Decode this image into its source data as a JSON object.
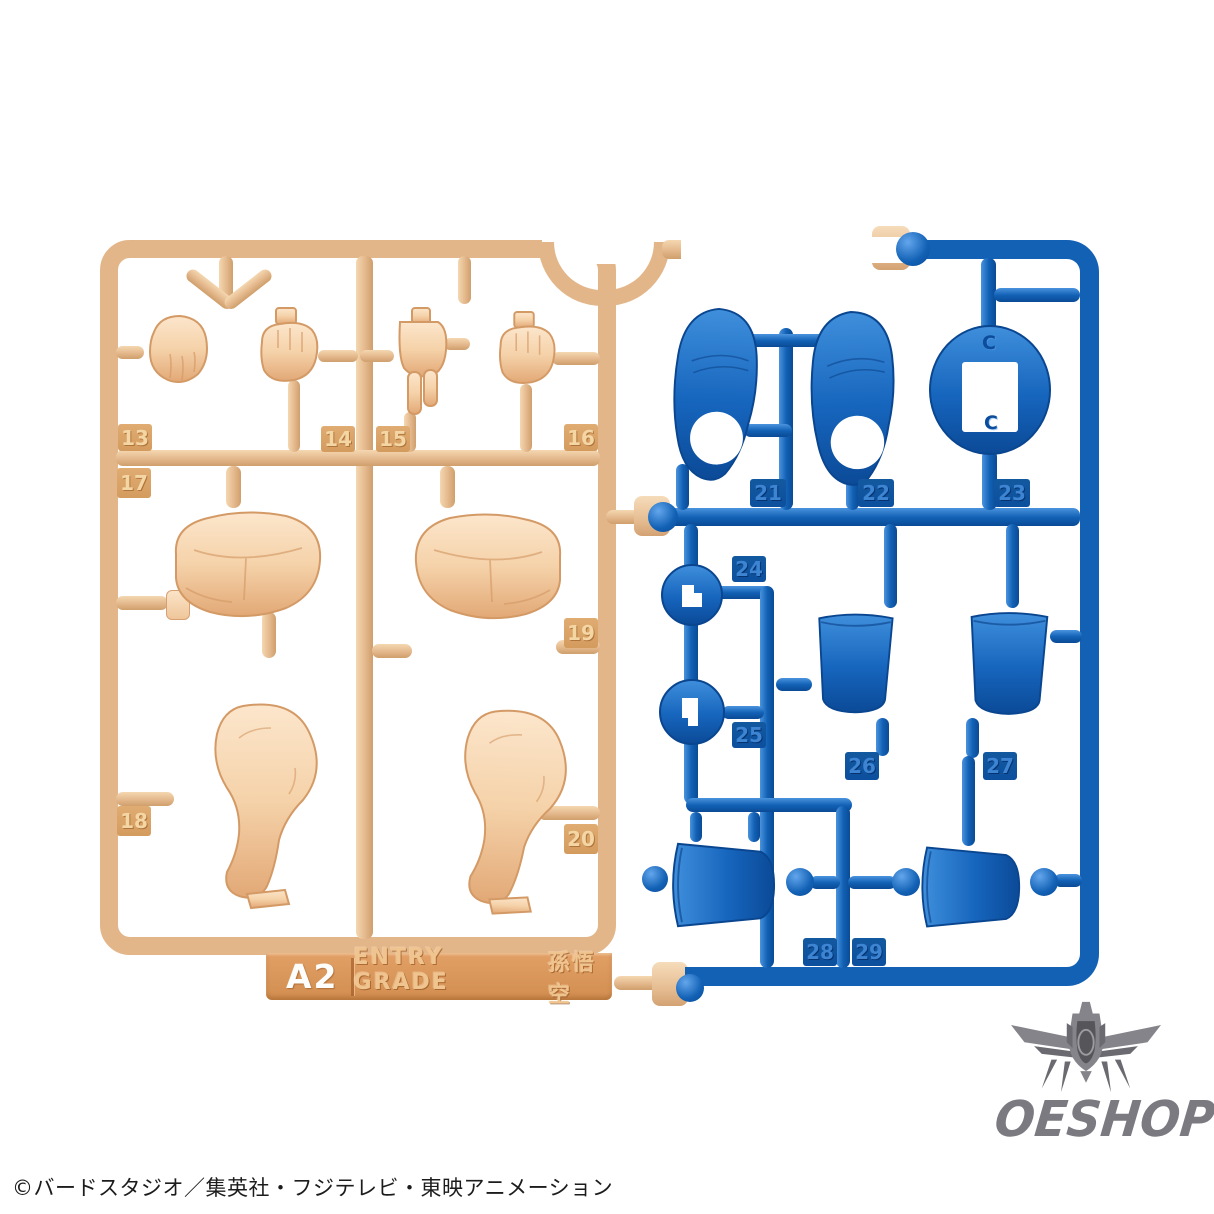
{
  "runner_label": {
    "code": "A2",
    "series": "ENTRY GRADE",
    "character": "孫悟空"
  },
  "tan_runner": {
    "plastic_color": "#e3b689",
    "part_color": "#f5d3a9",
    "part_numbers": [
      "13",
      "14",
      "15",
      "16",
      "17",
      "18",
      "19",
      "20"
    ]
  },
  "blue_runner": {
    "plastic_color": "#1261b5",
    "part_numbers": [
      "21",
      "22",
      "23",
      "24",
      "25",
      "26",
      "27",
      "28",
      "29"
    ],
    "mold_marks": [
      "C",
      "C"
    ]
  },
  "watermark": {
    "brand": "OESHOP",
    "suffix": ".co.uk"
  },
  "footer": {
    "copyright": "©バードスタジオ／集英社・フジテレビ・東映アニメーション"
  }
}
